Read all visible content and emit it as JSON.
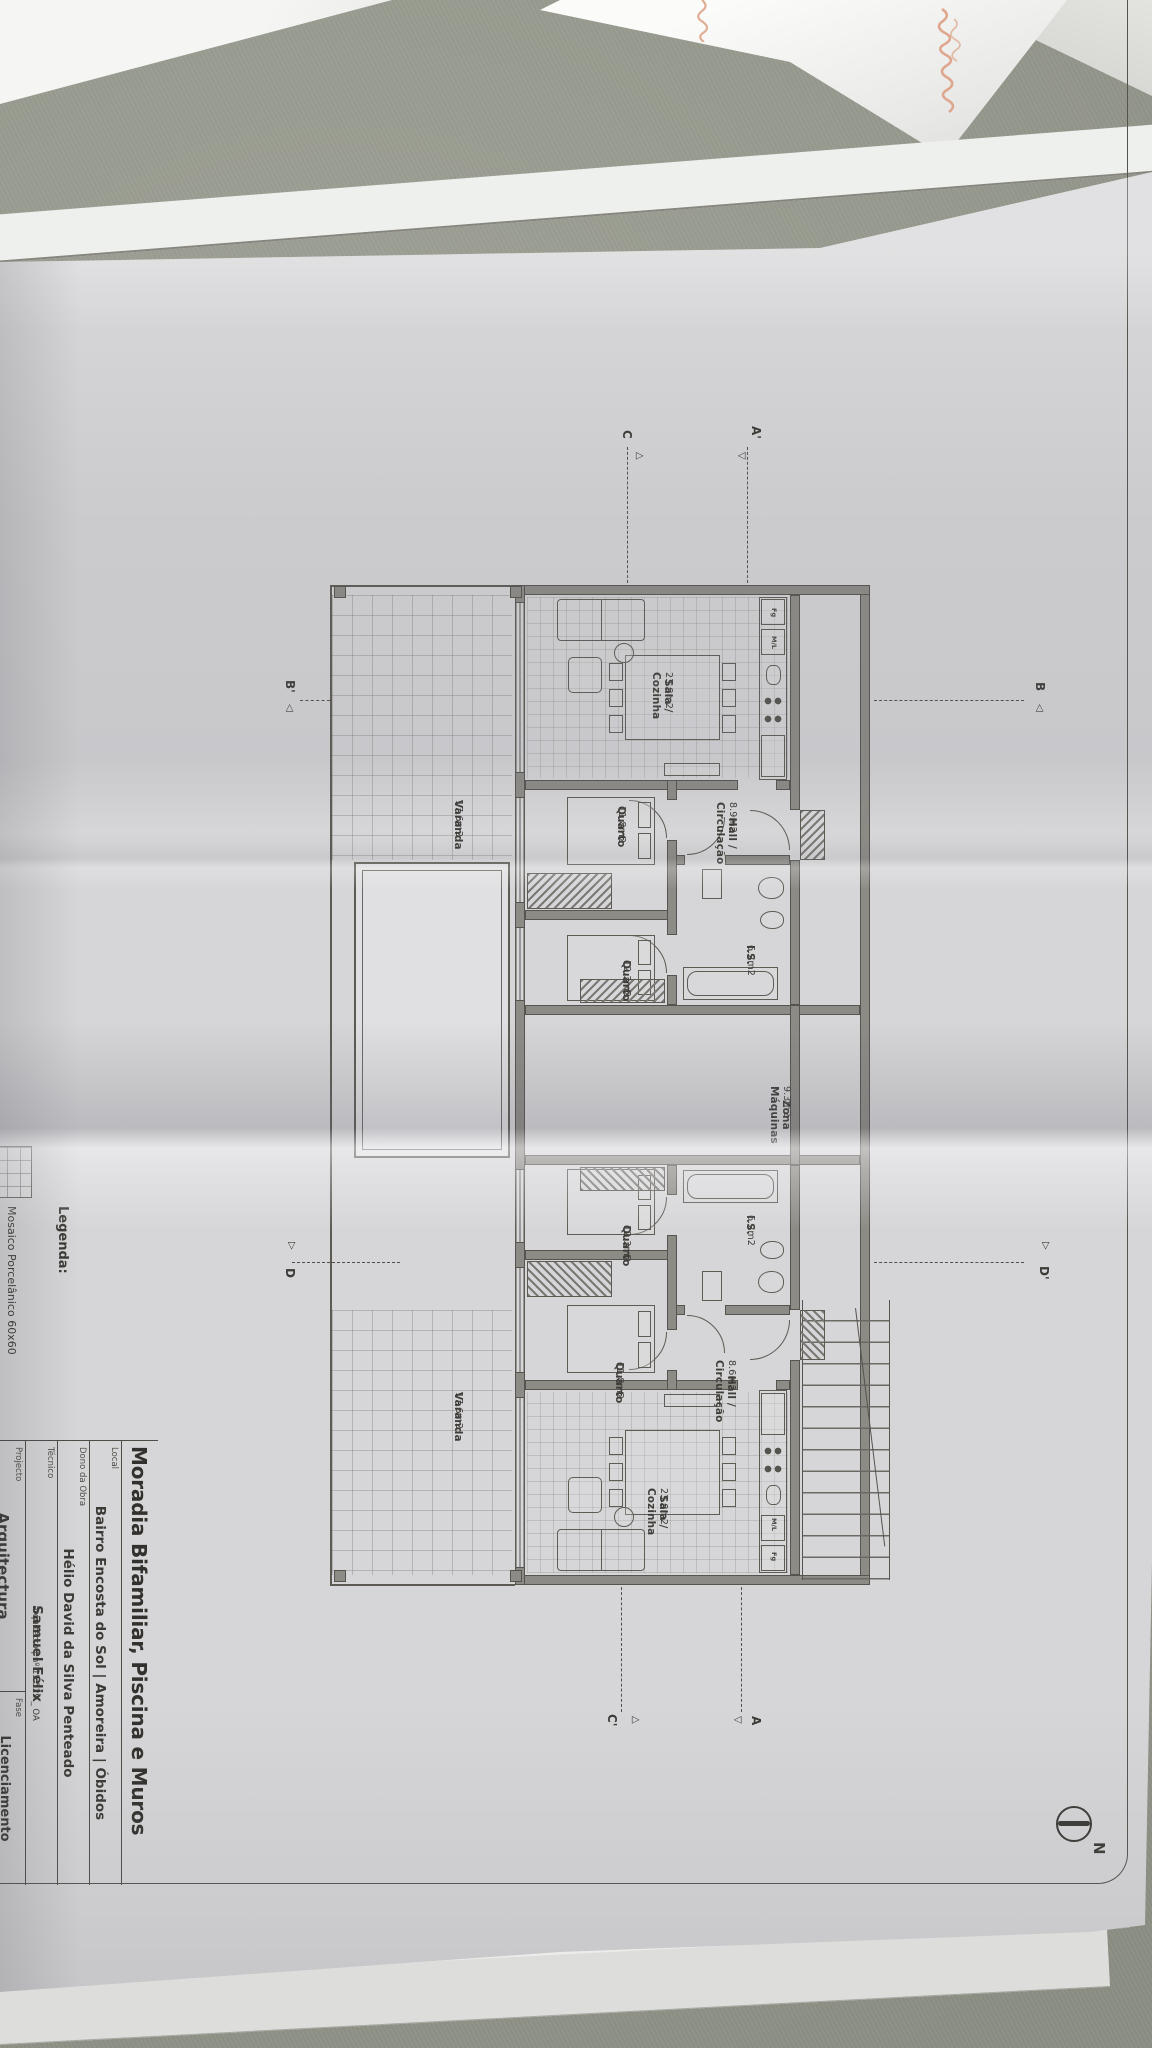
{
  "sheet": {
    "title_block": {
      "title": "Moradia Bifamiliar, Piscina e Muros",
      "fields": [
        {
          "label": "Local",
          "value": "Bairro Encosta do Sol | Amoreira | Óbidos"
        },
        {
          "label": "Dono da Obra",
          "value": "Hélio David da Silva Penteado"
        },
        {
          "label": "Técnico",
          "value": "Samuel Félix",
          "value_suffix": "arquitecto | nº 15.529 _ OA"
        },
        {
          "label": "Projecto",
          "value": "Arquitectura"
        },
        {
          "label": "Fase",
          "value": "Licenciamento"
        }
      ]
    },
    "legend": {
      "heading": "Legenda:",
      "items": [
        {
          "swatch": "tile-grid",
          "label": "Mosaico Porcelânico 60x60"
        }
      ]
    },
    "compass": {
      "label": "N"
    },
    "plan": {
      "unit_a": {
        "rooms": [
          {
            "name": "Sala / Cozinha",
            "area": "23.8m2"
          },
          {
            "name": "Hall /\nCirculação",
            "area": "8.9m2"
          },
          {
            "name": "I.S.",
            "area": "6.2m2"
          },
          {
            "name": "Quarto",
            "area": "11.8m2"
          },
          {
            "name": "Quarto",
            "area": "12.3m2"
          },
          {
            "name": "Varanda",
            "area": "17.6m2"
          }
        ]
      },
      "unit_b": {
        "rooms": [
          {
            "name": "Sala / Cozinha",
            "area": "23.8m2"
          },
          {
            "name": "Hall /\nCirculação",
            "area": "8.6m2"
          },
          {
            "name": "I.S.",
            "area": "6.2m2"
          },
          {
            "name": "Quarto",
            "area": "11.8m2"
          },
          {
            "name": "Quarto",
            "area": "12.3m2"
          },
          {
            "name": "Varanda",
            "area": "17.6m2"
          }
        ]
      },
      "zona_maquinas": {
        "name": "Zona Máquinas",
        "area": "9.3m2"
      },
      "kitchen": {
        "fridge": "Fg",
        "washer": "M/L"
      },
      "section_markers": {
        "a": "A",
        "a_prime": "A'",
        "b": "B",
        "b_prime": "B'",
        "c": "C",
        "c_prime": "C'",
        "d": "D",
        "d_prime": "D'"
      }
    }
  }
}
